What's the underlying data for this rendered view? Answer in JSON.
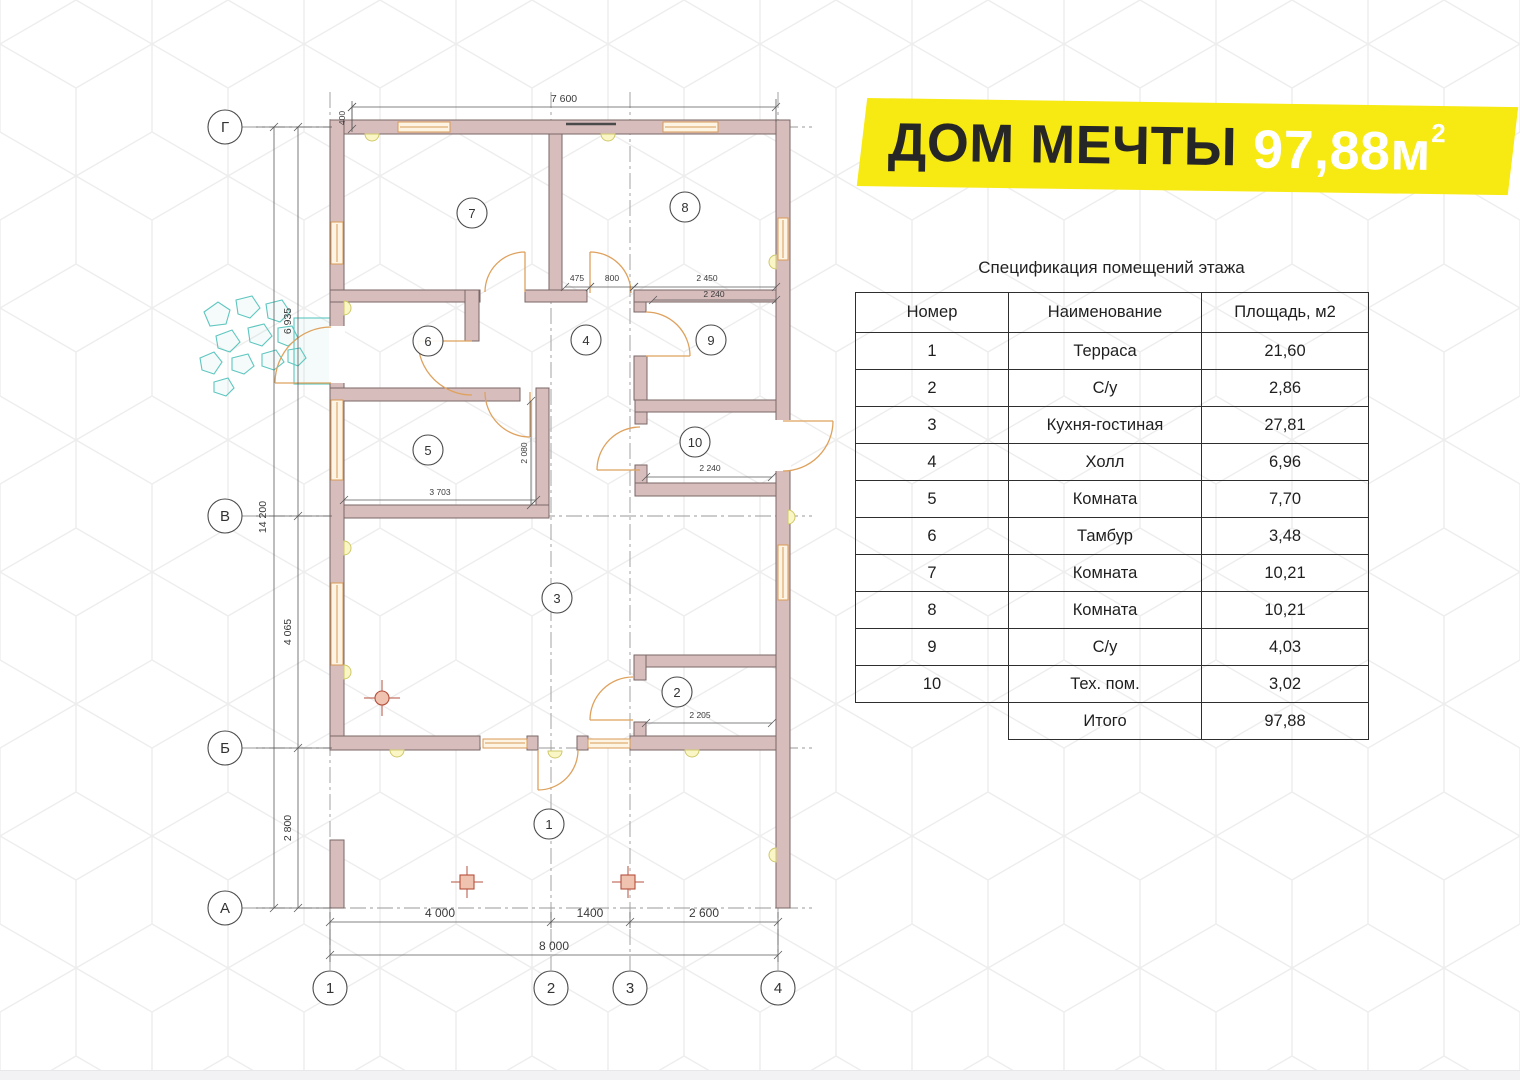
{
  "banner": {
    "title_black": "ДОМ МЕЧТЫ",
    "area_value": "97,88м",
    "area_sup": "2"
  },
  "spec": {
    "title": "Спецификация помещений этажа",
    "columns": [
      "Номер",
      "Наименование",
      "Площадь, м2"
    ],
    "rows": [
      [
        "1",
        "Терраса",
        "21,60"
      ],
      [
        "2",
        "С/у",
        "2,86"
      ],
      [
        "3",
        "Кухня-гостиная",
        "27,81"
      ],
      [
        "4",
        "Холл",
        "6,96"
      ],
      [
        "5",
        "Комната",
        "7,70"
      ],
      [
        "6",
        "Тамбур",
        "3,48"
      ],
      [
        "7",
        "Комната",
        "10,21"
      ],
      [
        "8",
        "Комната",
        "10,21"
      ],
      [
        "9",
        "С/у",
        "4,03"
      ],
      [
        "10",
        "Тех. пом.",
        "3,02"
      ]
    ],
    "total_label": "Итого",
    "total_value": "97,88"
  },
  "plan": {
    "room_labels": [
      "1",
      "2",
      "3",
      "4",
      "5",
      "6",
      "7",
      "8",
      "9",
      "10"
    ],
    "axes_rows": [
      "Г",
      "В",
      "Б",
      "А"
    ],
    "axes_cols": [
      "1",
      "2",
      "3",
      "4"
    ],
    "dims": {
      "top_width": "7 600",
      "top_offset": "400",
      "left_total": "14 200",
      "left_gv": "6 935",
      "left_vb": "4 065",
      "left_ba": "2 800",
      "bottom_12": "4 000",
      "bottom_23": "1400",
      "bottom_34": "2 600",
      "bottom_total": "8 000",
      "hall_a": "475",
      "hall_b": "800",
      "room9_w": "2 450",
      "room9_w2": "2 240",
      "room5_h": "2 080",
      "room5_w": "3 703",
      "room10_w": "2 240",
      "room2_w": "2 205"
    },
    "colors": {
      "wall_fill": "#d8bdbd",
      "wall_stroke": "#7a6666",
      "door_orange": "#dfa25e",
      "window_orange": "#d89a55",
      "teal": "#5ec6bf",
      "red_marker": "#b5503c",
      "vent_yellow": "#cfc96a",
      "banner_yellow": "#f7e912"
    }
  }
}
